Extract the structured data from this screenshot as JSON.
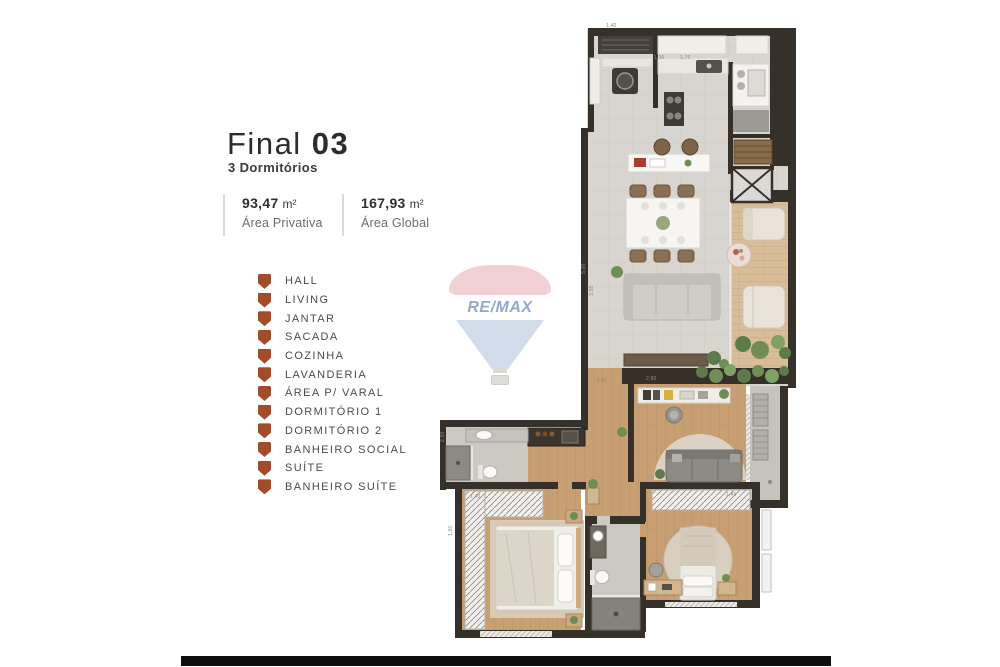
{
  "header": {
    "title_regular": "Final",
    "title_bold": "03",
    "subtitle": "3 Dormitórios"
  },
  "areas": [
    {
      "value": "93,47",
      "unit": "m²",
      "label": "Área Privativa"
    },
    {
      "value": "167,93",
      "unit": "m²",
      "label": "Área Global"
    }
  ],
  "legend": {
    "items": [
      {
        "label": "HALL"
      },
      {
        "label": "LIVING"
      },
      {
        "label": "JANTAR"
      },
      {
        "label": "SACADA"
      },
      {
        "label": "COZINHA"
      },
      {
        "label": "LAVANDERIA"
      },
      {
        "label": "ÁREA P/ VARAL"
      },
      {
        "label": "DORMITÓRIO 1"
      },
      {
        "label": "DORMITÓRIO 2"
      },
      {
        "label": "BANHEIRO SOCIAL"
      },
      {
        "label": "SUÍTE"
      },
      {
        "label": "BANHEIRO SUÍTE"
      }
    ]
  },
  "watermark": {
    "logo_text": "RE/MAX"
  },
  "plan": {
    "dimensions": [
      {
        "text": "1,40"
      },
      {
        "text": "1,36"
      },
      {
        "text": "1,75"
      },
      {
        "text": "5,00"
      },
      {
        "text": "3,55"
      },
      {
        "text": "3,00"
      },
      {
        "text": "2,80"
      },
      {
        "text": "2,50"
      },
      {
        "text": "1,40"
      },
      {
        "text": "1,60"
      },
      {
        "text": "1,49"
      }
    ]
  },
  "colors": {
    "legend_icon": "#a24c2a",
    "wall": "#36302a",
    "tile": "#d8d5d0",
    "wood": "#c79f72",
    "deck": "#d8bd98",
    "bath_tile": "#ccc8c3",
    "remax_red": "#f2cdd1",
    "remax_blue_text": "#8ea4cf",
    "remax_envelope_blue": "#cfdae9",
    "bottom_bar": "#0e0e0e"
  }
}
